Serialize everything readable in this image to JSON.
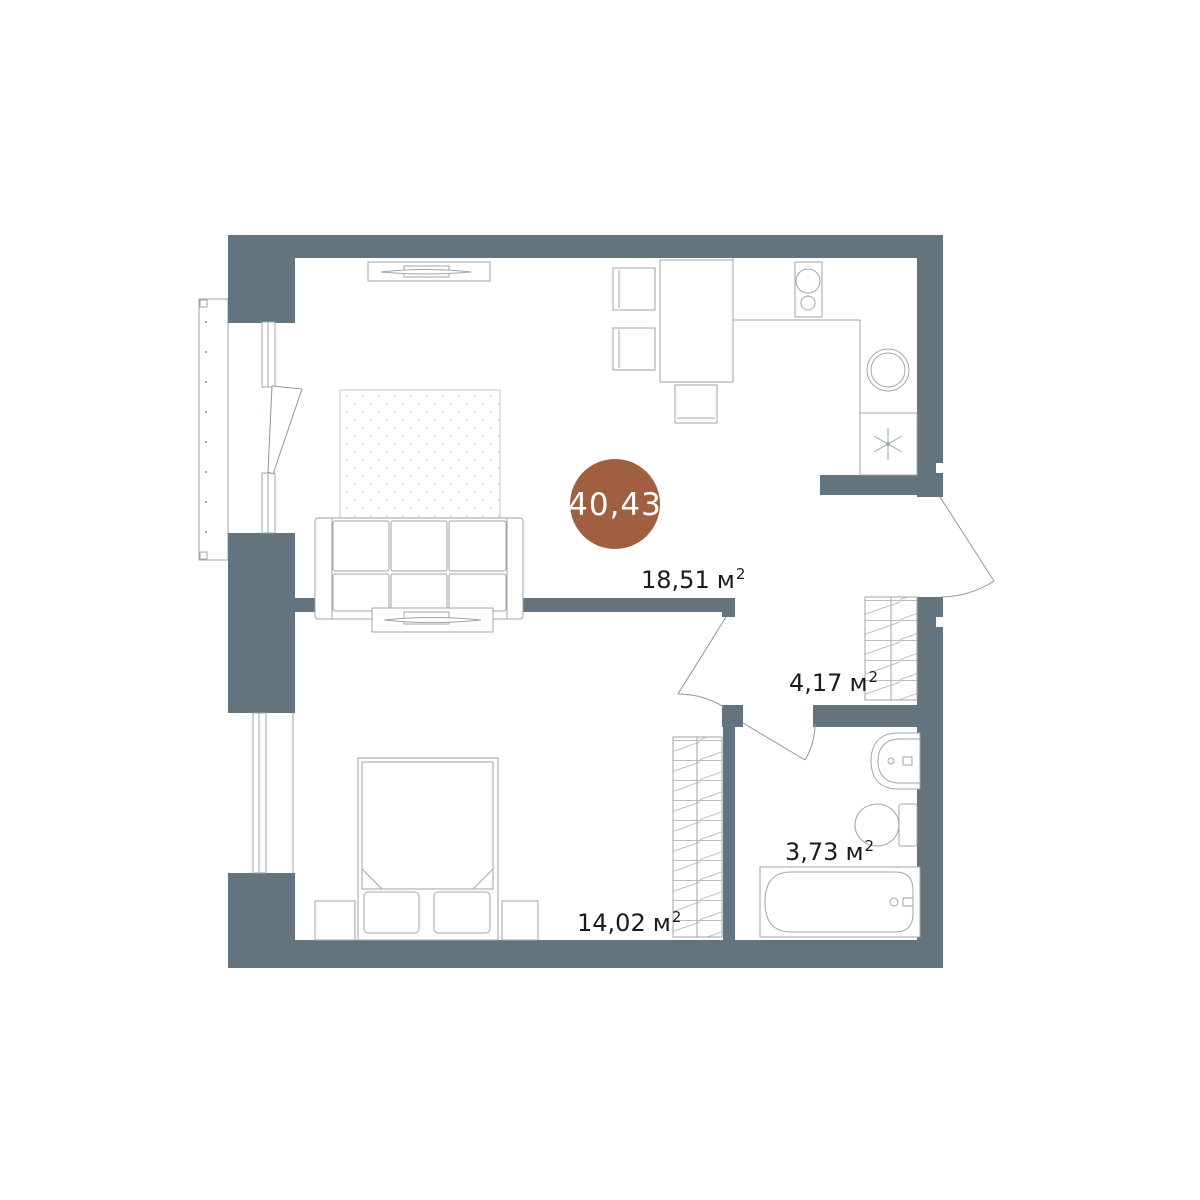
{
  "colors": {
    "wall": "#64747e",
    "area_circle": "#a15f41",
    "circle_text": "#ffffff",
    "label_text": "#1b1b1b",
    "furniture_line": "#9fa6ab",
    "door_line": "#8e979c",
    "hatch_line": "#b9bfc3",
    "rug_dot": "#c6cbce"
  },
  "labels": {
    "total_area": "40,43",
    "living_kitchen": {
      "area": "18,51",
      "unit": "м",
      "sup": "2"
    },
    "hallway": {
      "area": "4,17",
      "unit": "м",
      "sup": "2"
    },
    "bedroom": {
      "area": "14,02",
      "unit": "м",
      "sup": "2"
    },
    "bathroom": {
      "area": "3,73",
      "unit": "м",
      "sup": "2"
    }
  }
}
